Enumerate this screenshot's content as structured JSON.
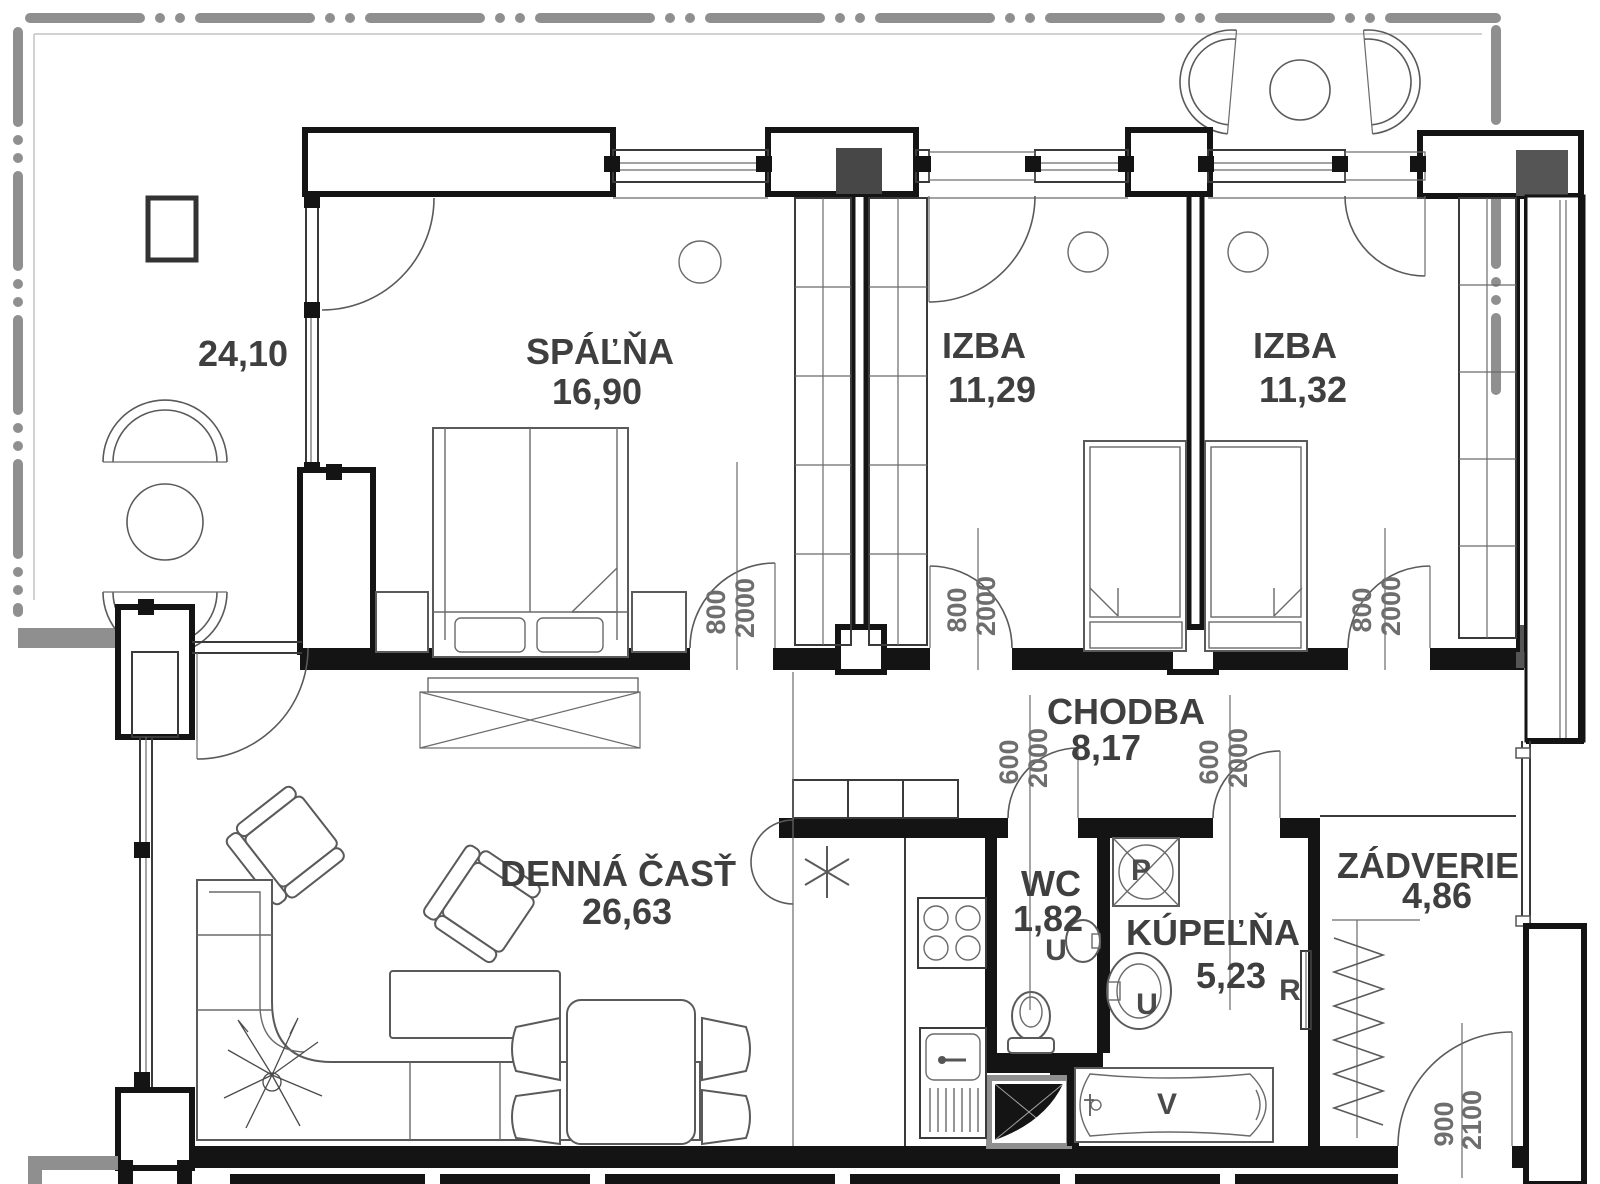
{
  "title": "Apartment floor plan",
  "rooms": [
    {
      "id": "spalna",
      "name": "SPÁĽŇA",
      "area": "16,90"
    },
    {
      "id": "izba1",
      "name": "IZBA",
      "area": "11,29"
    },
    {
      "id": "izba2",
      "name": "IZBA",
      "area": "11,32"
    },
    {
      "id": "denna",
      "name": "DENNÁ ČASŤ",
      "area": "26,63"
    },
    {
      "id": "chodba",
      "name": "CHODBA",
      "area": "8,17"
    },
    {
      "id": "wc",
      "name": "WC",
      "area": "1,82"
    },
    {
      "id": "kupelna",
      "name": "KÚPEĽŇA",
      "area": "5,23"
    },
    {
      "id": "zadverie",
      "name": "ZÁDVERIE",
      "area": "4,86"
    }
  ],
  "terrace": {
    "area": "24,10"
  },
  "door_dimensions": [
    {
      "room": "spalna",
      "width": "800",
      "height": "2000"
    },
    {
      "room": "izba1",
      "width": "800",
      "height": "2000"
    },
    {
      "room": "izba2",
      "width": "800",
      "height": "2000"
    },
    {
      "room": "wc",
      "width": "600",
      "height": "2000"
    },
    {
      "room": "kupelna",
      "width": "600",
      "height": "2000"
    },
    {
      "room": "entrance",
      "width": "900",
      "height": "2100"
    }
  ],
  "fixtures": {
    "wc_washbasin": "U",
    "bath_washbasin": "U",
    "washing_machine": "P",
    "radiator": "R",
    "bathtub": "V"
  },
  "colors": {
    "wall": "#141414",
    "terrace_boundary": "#8f8f8f",
    "label": "#3f3f3f",
    "dimension": "#6e6e6e"
  }
}
